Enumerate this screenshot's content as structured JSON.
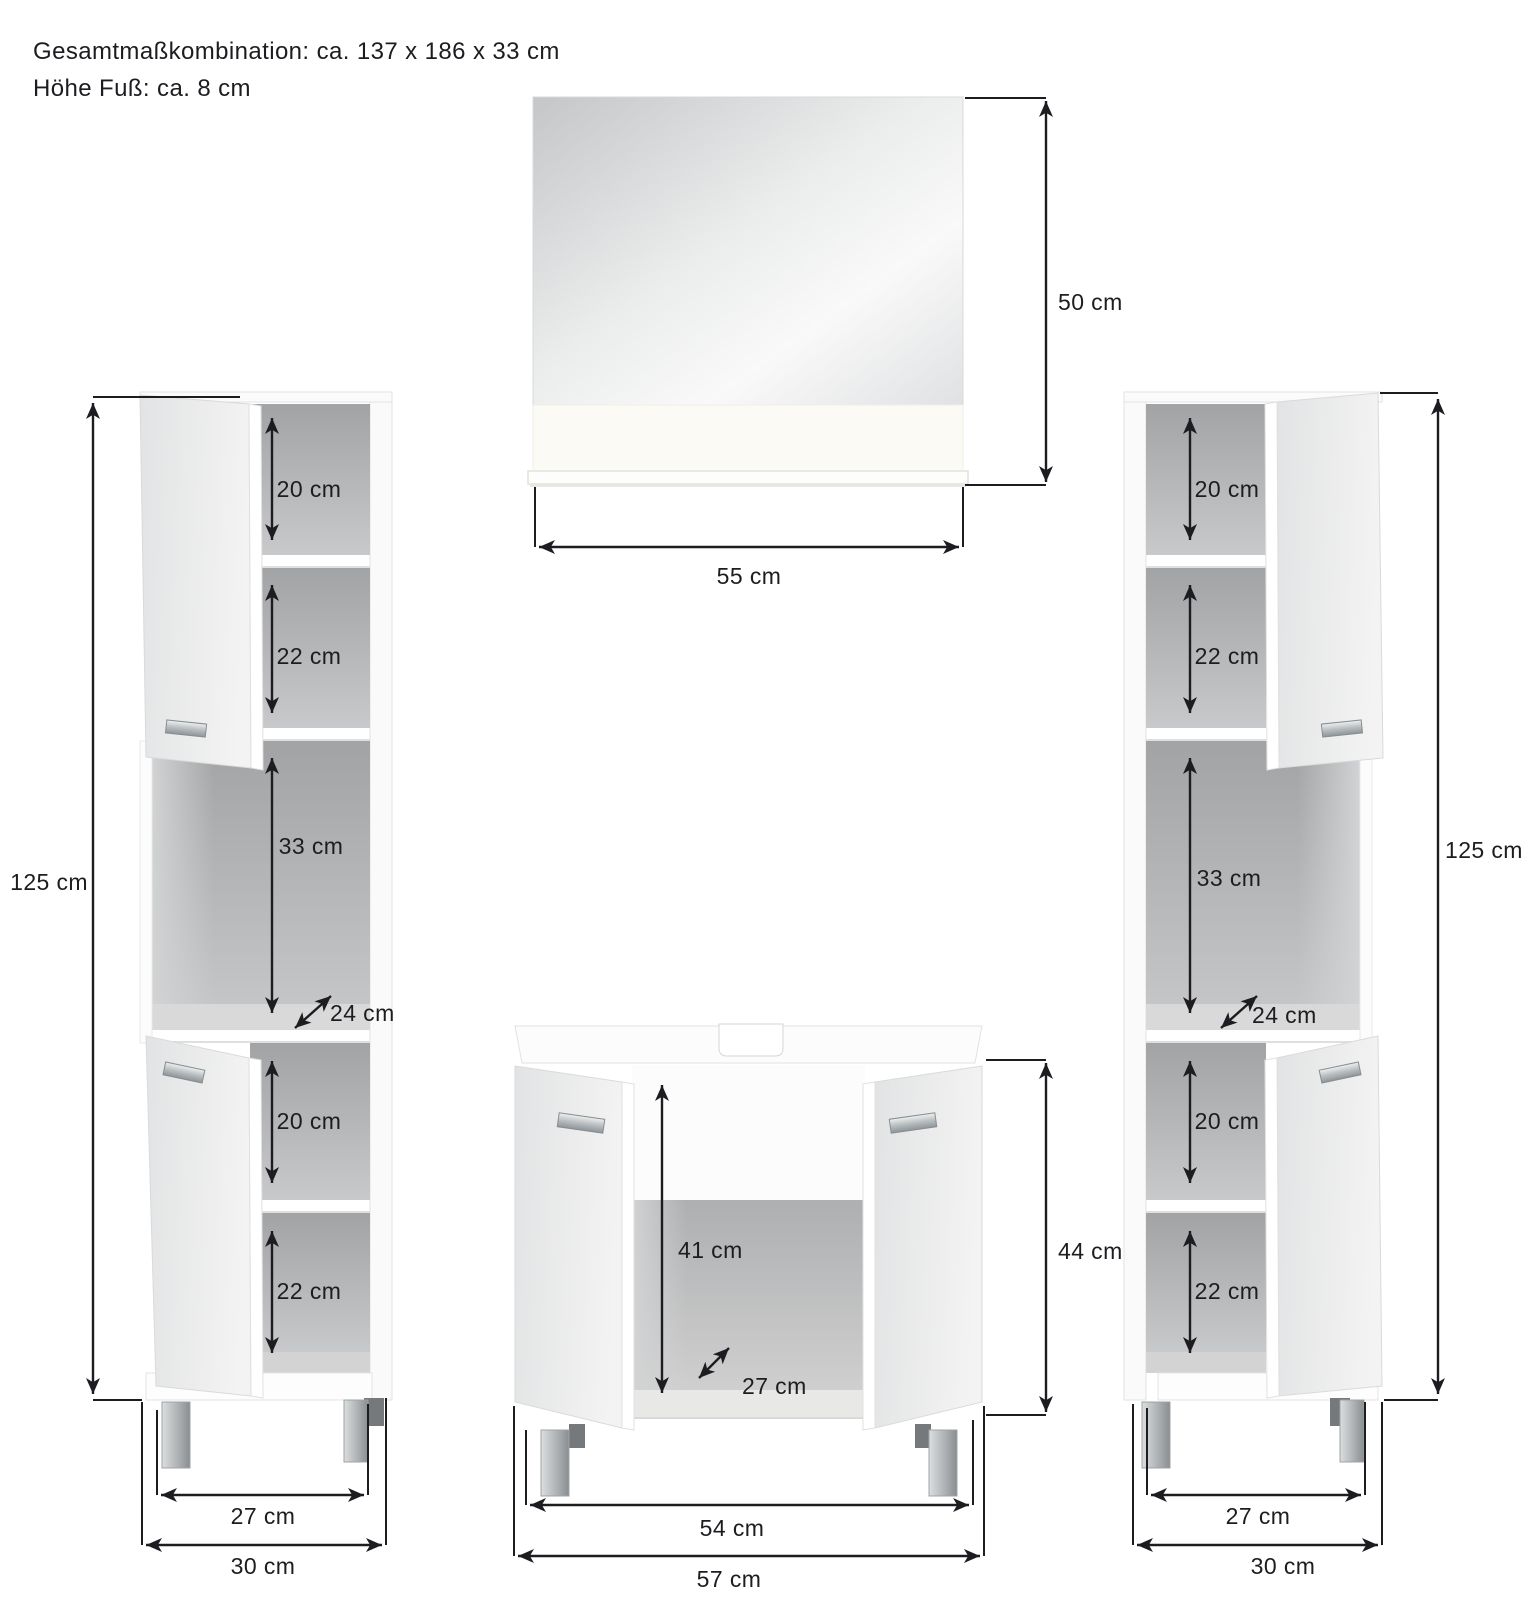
{
  "title": {
    "line1": "Gesamtmaßkombination: ca. 137 x 186 x 33 cm",
    "line2": "Höhe Fuß: ca. 8 cm"
  },
  "colors": {
    "dimension_lines": "#1d1d21",
    "cabinet_interior_gray": "#a8a9ab",
    "door_front_gray": "#e8e9e9",
    "chrome_leg": "#9aa0a3",
    "background": "#ffffff"
  },
  "mirror": {
    "height": "50 cm",
    "width": "55 cm"
  },
  "left_cabinet": {
    "total_height": "125 cm",
    "compartment_1": "20 cm",
    "compartment_2": "22 cm",
    "open_compartment": "33 cm",
    "depth": "24 cm",
    "compartment_4": "20 cm",
    "compartment_5": "22 cm",
    "inner_width": "27 cm",
    "outer_width": "30 cm"
  },
  "sink_cabinet": {
    "inner_height": "41 cm",
    "inner_depth": "27 cm",
    "body_height": "44 cm",
    "inner_width": "54 cm",
    "outer_width": "57 cm"
  },
  "right_cabinet": {
    "total_height": "125 cm",
    "compartment_1": "20 cm",
    "compartment_2": "22 cm",
    "open_compartment": "33 cm",
    "depth": "24 cm",
    "compartment_4": "20 cm",
    "compartment_5": "22 cm",
    "inner_width": "27 cm",
    "outer_width": "30 cm"
  }
}
